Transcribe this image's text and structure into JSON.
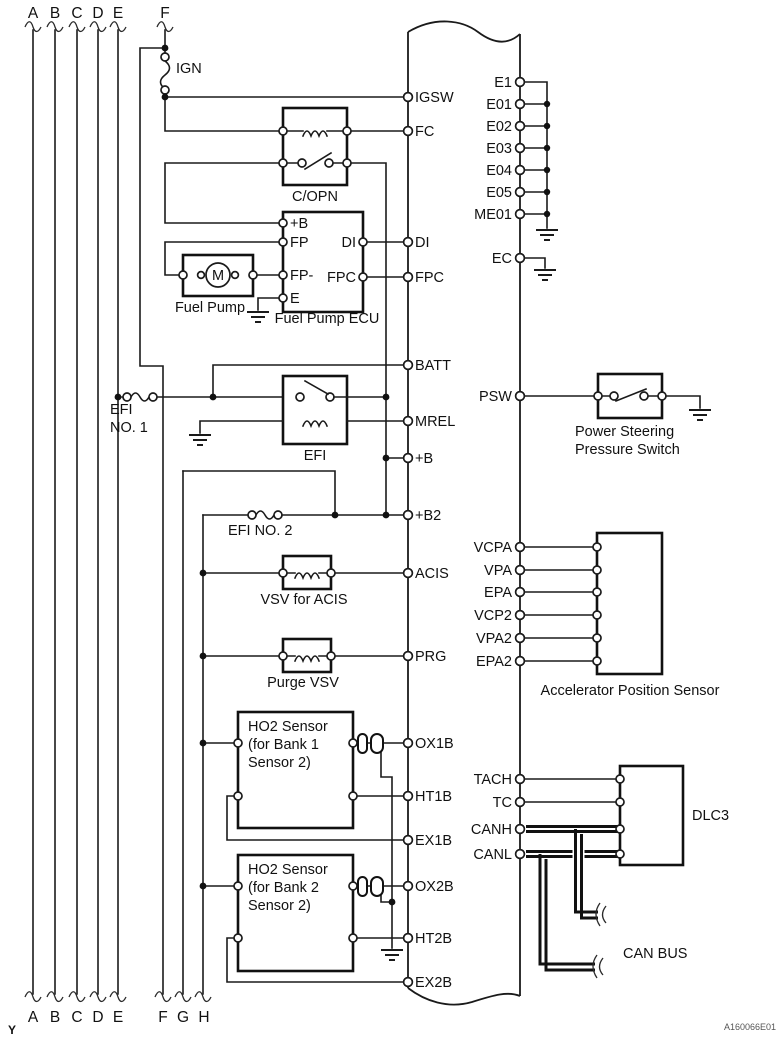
{
  "figure": {
    "code": "A160066E01",
    "page_marker": "Y",
    "motor_label": "M"
  },
  "connectors": {
    "top": [
      "A",
      "B",
      "C",
      "D",
      "E",
      "F"
    ],
    "bottom": [
      "A",
      "B",
      "C",
      "D",
      "E",
      "F",
      "G",
      "H"
    ]
  },
  "fuses": {
    "ign": "IGN",
    "efi1_line1": "EFI",
    "efi1_line2": "NO. 1",
    "efi2": "EFI NO. 2"
  },
  "relays": {
    "copn": "C/OPN",
    "efi": "EFI"
  },
  "components": {
    "fuel_pump": "Fuel Pump",
    "fuel_pump_ecu": "Fuel Pump ECU",
    "fp_ecu": {
      "plus_b": "+B",
      "fp": "FP",
      "fp_minus": "FP-",
      "e": "E",
      "di": "DI",
      "fpc": "FPC"
    },
    "vsv_acis": "VSV for ACIS",
    "purge_vsv": "Purge VSV",
    "ho2_bank1": {
      "l1": "HO2 Sensor",
      "l2": "(for Bank 1",
      "l3": "Sensor 2)"
    },
    "ho2_bank2": {
      "l1": "HO2 Sensor",
      "l2": "(for Bank 2",
      "l3": "Sensor 2)"
    },
    "psw": {
      "l1": "Power Steering",
      "l2": "Pressure Switch"
    },
    "aps": "Accelerator Position Sensor",
    "dlc3": "DLC3",
    "can_bus": "CAN BUS"
  },
  "ecm": {
    "left": [
      "IGSW",
      "FC",
      "DI",
      "FPC",
      "BATT",
      "MREL",
      "+B",
      "+B2",
      "ACIS",
      "PRG",
      "OX1B",
      "HT1B",
      "EX1B",
      "OX2B",
      "HT2B",
      "EX2B"
    ],
    "right": [
      "E1",
      "E01",
      "E02",
      "E03",
      "E04",
      "E05",
      "ME01",
      "EC",
      "PSW",
      "VCPA",
      "VPA",
      "EPA",
      "VCP2",
      "VPA2",
      "EPA2",
      "TACH",
      "TC",
      "CANH",
      "CANL"
    ]
  }
}
